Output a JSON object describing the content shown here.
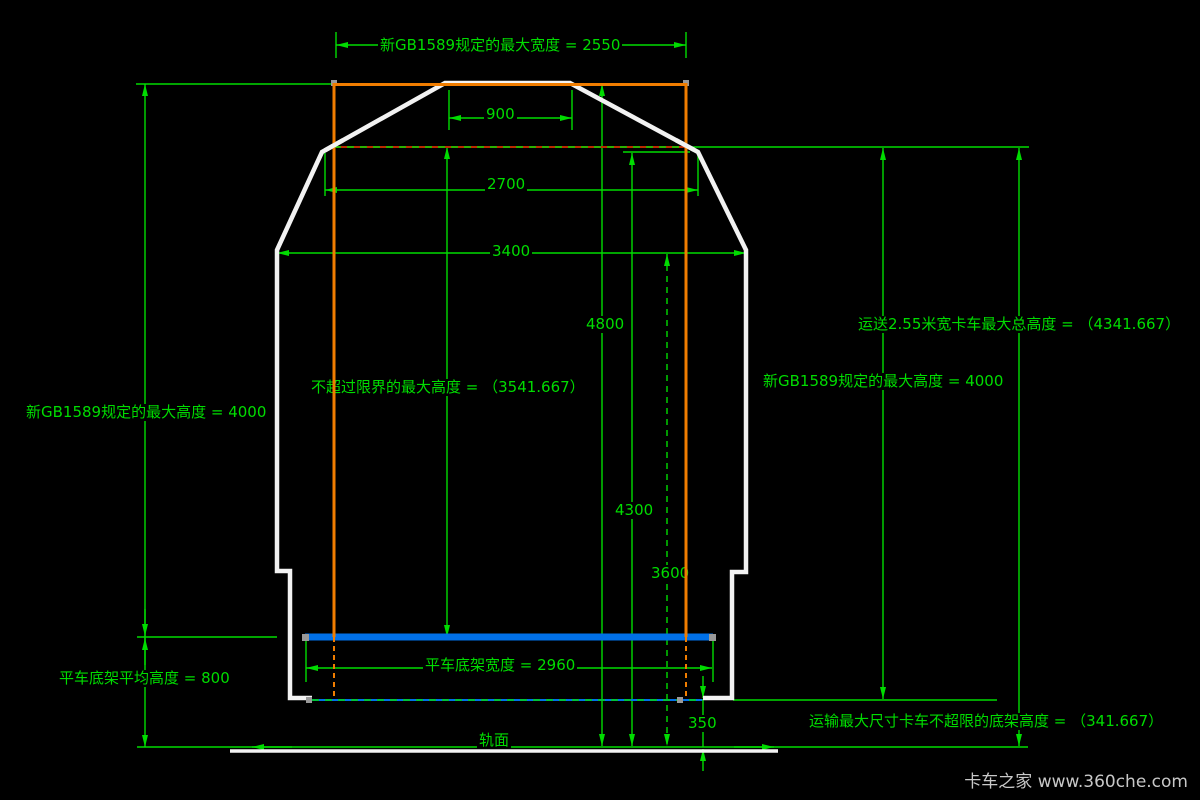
{
  "labels": {
    "max_width": "新GB1589规定的最大宽度 = 2550",
    "dim_900": "900",
    "dim_2700": "2700",
    "dim_3400": "3400",
    "dim_4800": "4800",
    "dim_4300": "4300",
    "dim_3600": "3600",
    "limit_height": "不超过限界的最大高度 = （3541.667）",
    "max_height_left": "新GB1589规定的最大高度 = 4000",
    "truck_total_height": "运送2.55米宽卡车最大总高度 = （4341.667）",
    "max_height_right": "新GB1589规定的最大高度 = 4000",
    "flatcar_deck_height": "平车底架平均高度 = 800",
    "flatcar_deck_width": "平车底架宽度 = 2960",
    "dim_350": "350",
    "chassis_height_limit": "运输最大尺寸卡车不超限的底架高度 = （341.667）",
    "rail_surface": "轨面",
    "watermark": "卡车之家 www.360che.com"
  },
  "colors": {
    "dimension_green": "#00DC00",
    "truck_outline_orange": "#F07D00",
    "gauge_outline_white": "#F2F2F2",
    "deck_blue": "#0070E8",
    "limit_dash_red": "#BB2B00",
    "background": "#000000",
    "watermark_gray": "#C8C8C8"
  }
}
